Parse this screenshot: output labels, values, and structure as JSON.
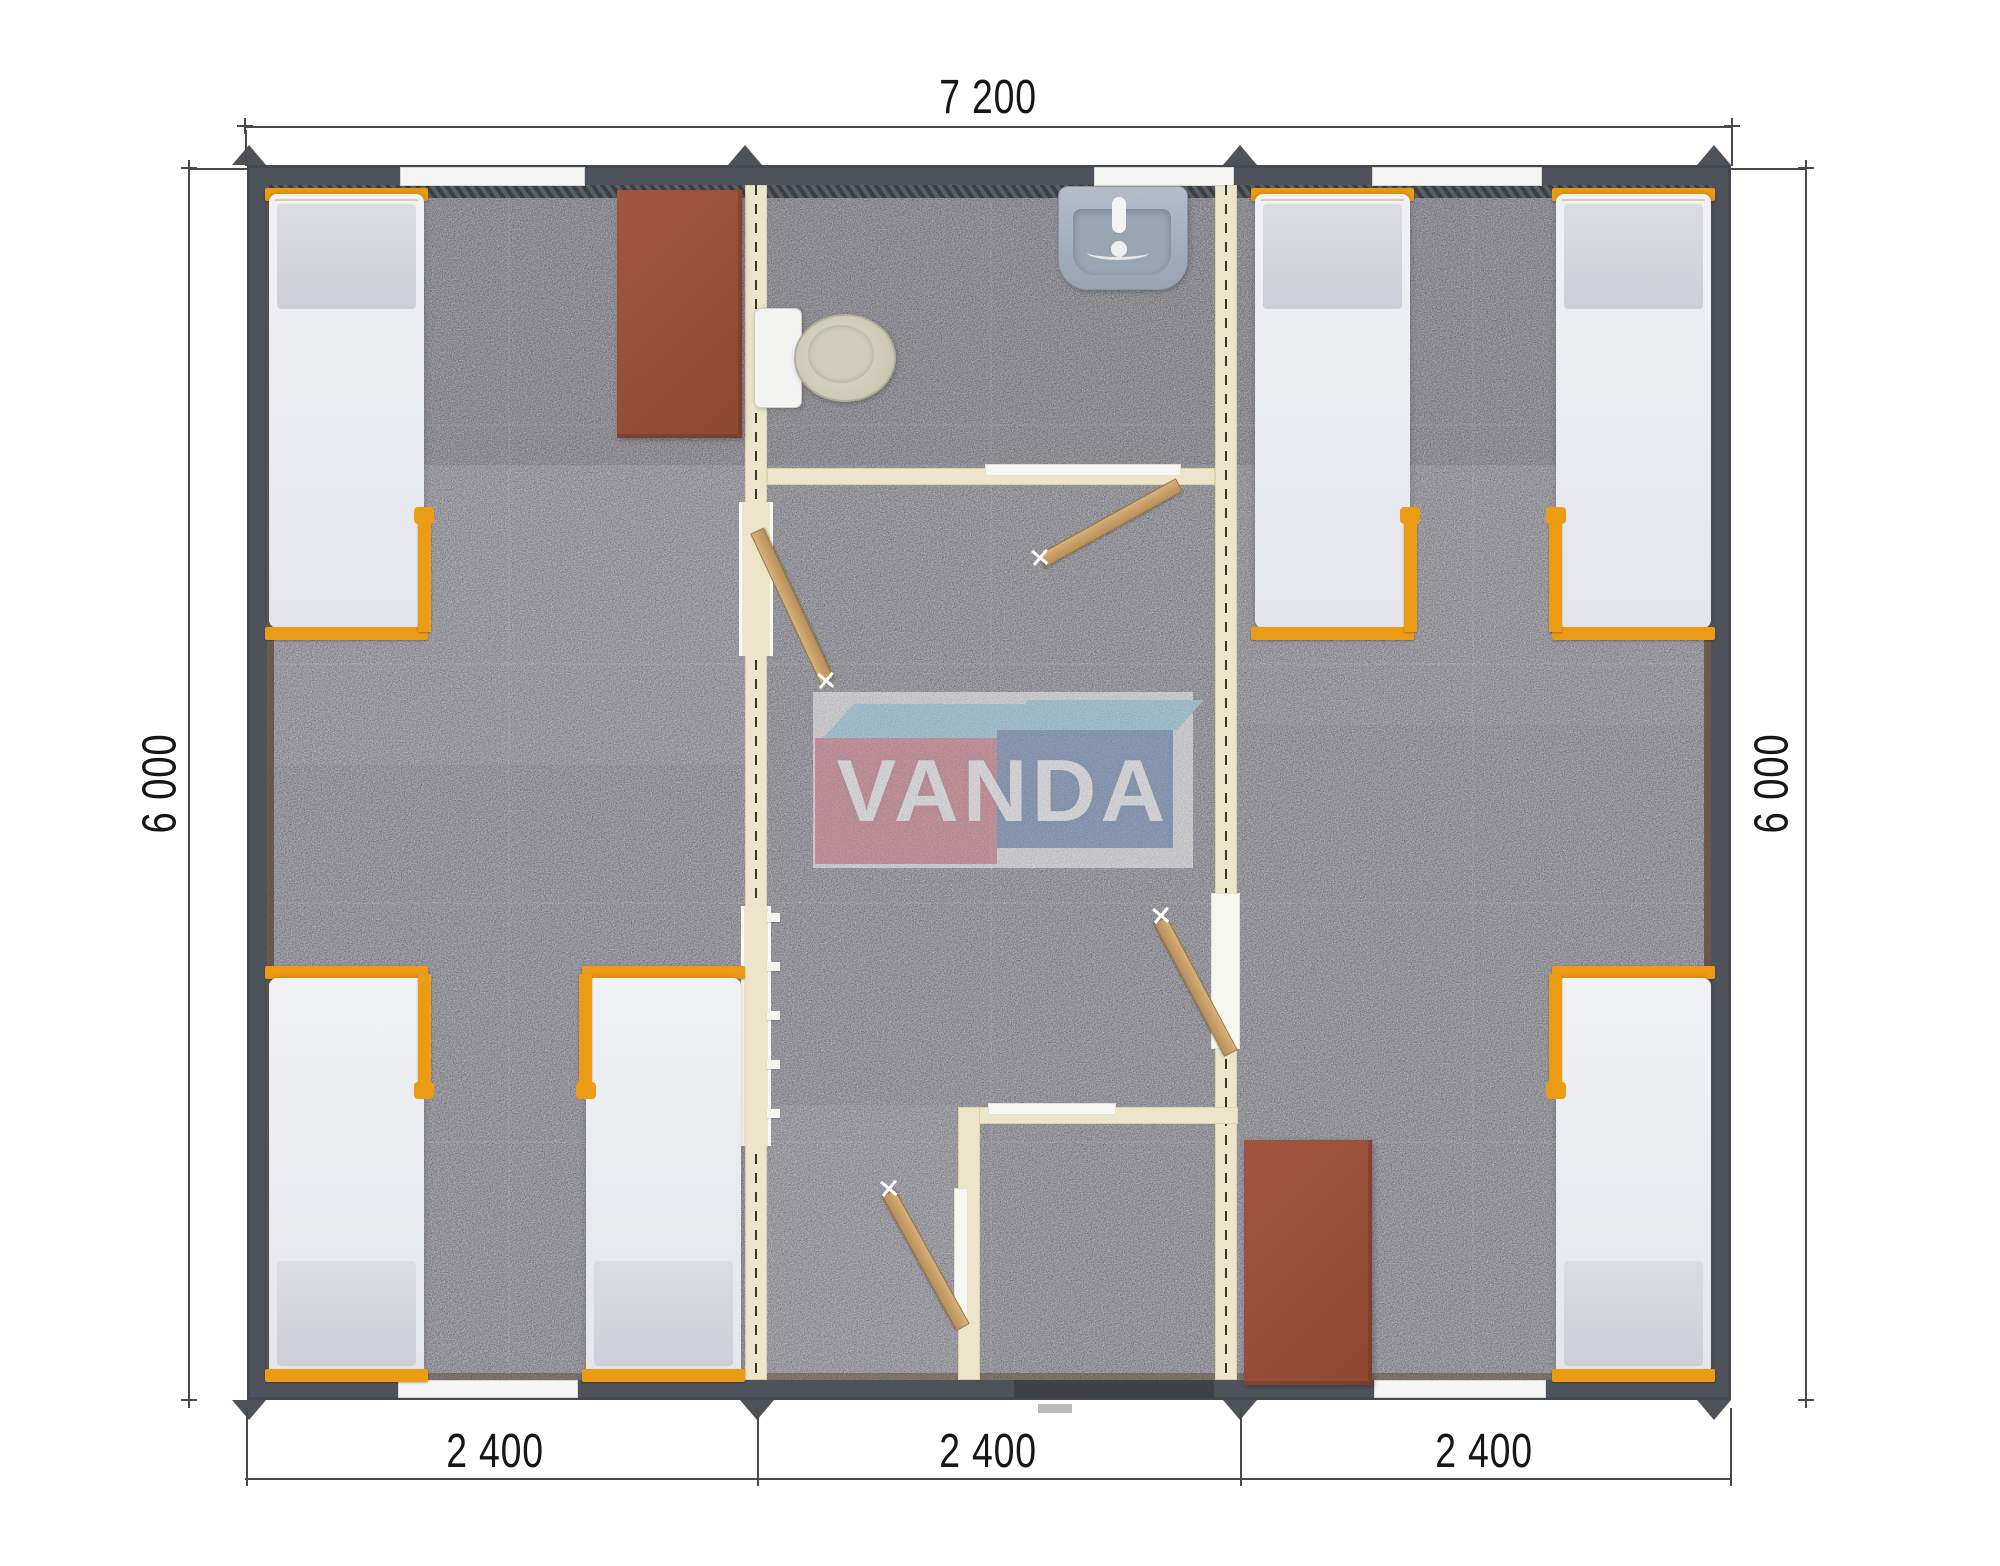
{
  "plan": {
    "type": "modular-building-floor-plan",
    "modules": 3,
    "fixtures": {
      "beds": 6,
      "desks": 2,
      "toilet": 1,
      "sink": 1,
      "doors": 4,
      "windows": 5,
      "entrance_threshold": 1
    }
  },
  "dimensions": {
    "top_width": "7 200",
    "left_height": "6 000",
    "right_height": "6 000",
    "bottom_modules": [
      "2 400",
      "2 400",
      "2 400"
    ]
  },
  "logo": {
    "text": "VANDA"
  },
  "colors": {
    "wall": "#4e525b",
    "floor": "#9b9ba3",
    "lining": "#57452f",
    "iwall": "#ece5c9",
    "iwall-edge": "#d9d1b0",
    "bed-frame": "#ec9c14",
    "desk": "#9d5138",
    "door": "#c8a06c",
    "toilet": "#cbc8b4",
    "sink": "#a9b2c0",
    "window": "#f5f6f4",
    "threshold": "#3e4147",
    "dim-line": "#4a4a4a",
    "text": "#161616",
    "logo-pink": "#d98a95",
    "logo-blue": "#7e96bc",
    "logo-sky": "#a6d6e8"
  }
}
